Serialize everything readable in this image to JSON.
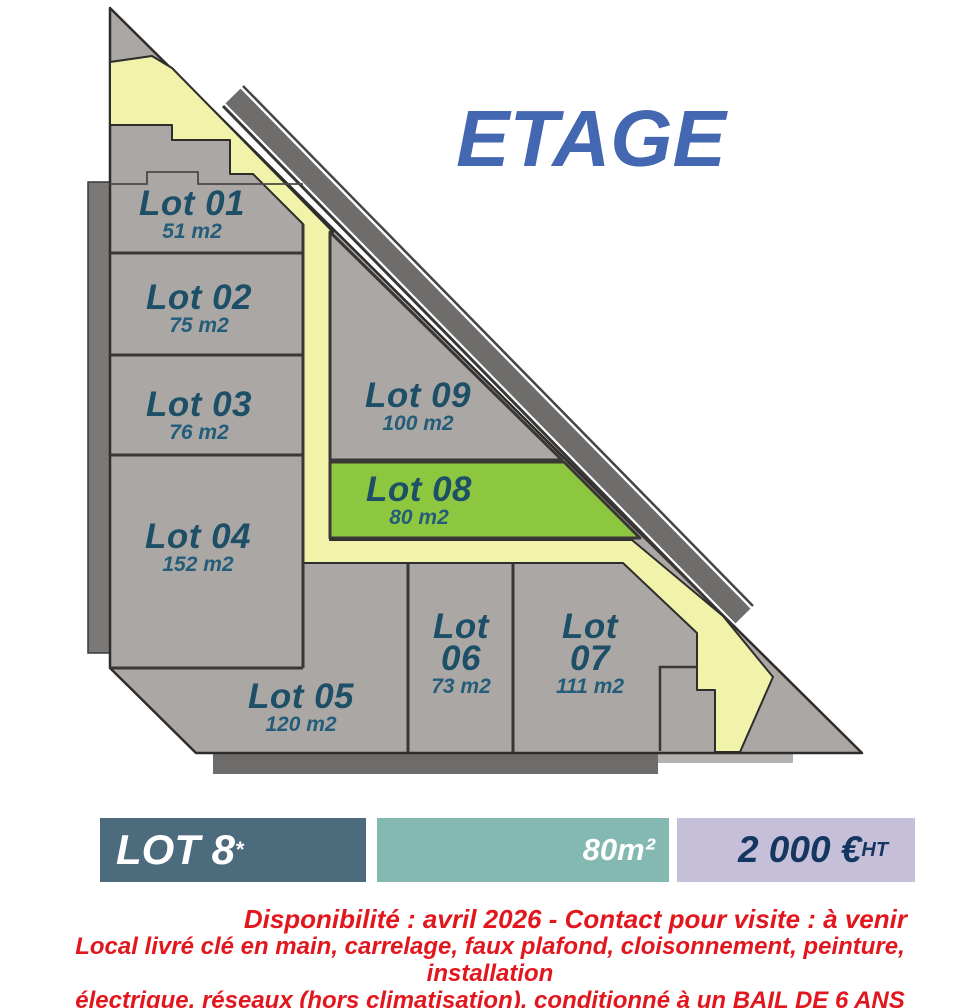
{
  "title": "ETAGE",
  "plan": {
    "lots": [
      {
        "name": "Lot 01",
        "name2": "",
        "area": "51 m2"
      },
      {
        "name": "Lot 02",
        "name2": "",
        "area": "75 m2"
      },
      {
        "name": "Lot 03",
        "name2": "",
        "area": "76 m2"
      },
      {
        "name": "Lot 04",
        "name2": "",
        "area": "152 m2"
      },
      {
        "name": "Lot 05",
        "name2": "",
        "area": "120 m2"
      },
      {
        "name": "Lot",
        "name2": "06",
        "area": "73 m2"
      },
      {
        "name": "Lot",
        "name2": "07",
        "area": "111 m2"
      },
      {
        "name": "Lot 08",
        "name2": "",
        "area": "80 m2",
        "highlighted": true
      },
      {
        "name": "Lot 09",
        "name2": "",
        "area": "100 m2"
      }
    ]
  },
  "legend": {
    "lot": {
      "text": "LOT 8",
      "sup": "*"
    },
    "area": {
      "text": "80m²"
    },
    "price": {
      "text": "2 000 €",
      "sup": "HT"
    }
  },
  "notes": {
    "line1": "Disponibilité : avril 2026 - Contact pour visite : à venir",
    "line2": "Local livré clé en main, carrelage, faux plafond, cloisonnement, peinture, installation",
    "line3": "électrique, réseaux (hors climatisation), conditionné à un BAIL DE 6 ANS FERME"
  },
  "colors": {
    "title_blue": "#4467b1",
    "lot_gray": "#aaa7a5",
    "lot_green": "#8dc63f",
    "corridor_yellow": "#f2f3aa",
    "roof_band_gray": "#6f6d6b",
    "label_navy": "#1d4f66",
    "legend_dark_slate": "#4c6b7d",
    "legend_teal": "#83b9b1",
    "legend_lavender": "#c6bfda",
    "legend_price_navy": "#15375f",
    "note_red": "#e2171e"
  }
}
